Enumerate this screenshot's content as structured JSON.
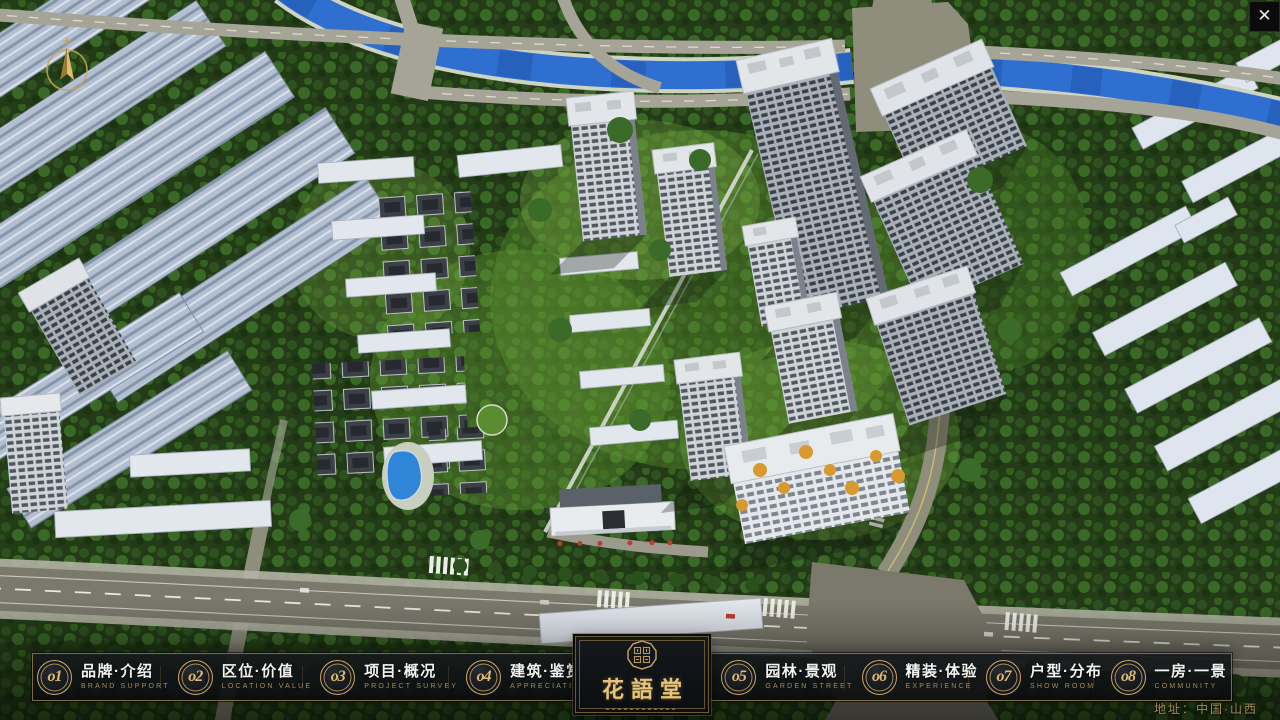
{
  "chrome": {
    "close_glyph": "✕"
  },
  "nav": {
    "items": [
      {
        "num": "o1",
        "zh": "品牌·介绍",
        "en": "BRAND SUPPORT"
      },
      {
        "num": "o2",
        "zh": "区位·价值",
        "en": "LOCATION VALUE"
      },
      {
        "num": "o3",
        "zh": "项目·概况",
        "en": "PROJECT SURVEY"
      },
      {
        "num": "o4",
        "zh": "建筑·鉴赏",
        "en": "APPRECIATION"
      },
      {
        "num": "o5",
        "zh": "园林·景观",
        "en": "GARDEN STREET"
      },
      {
        "num": "o6",
        "zh": "精装·体验",
        "en": "EXPERIENCE"
      },
      {
        "num": "o7",
        "zh": "户型·分布",
        "en": "SHOW ROOM"
      },
      {
        "num": "o8",
        "zh": "一房·一景",
        "en": "COMMUNITY"
      }
    ]
  },
  "logo": {
    "name": "花語堂"
  },
  "footer": {
    "address": "地址：中国·山西"
  },
  "colors": {
    "gold": "#c9a567",
    "bar_bg": "#0c0e10",
    "river": "#2f6fd0"
  }
}
